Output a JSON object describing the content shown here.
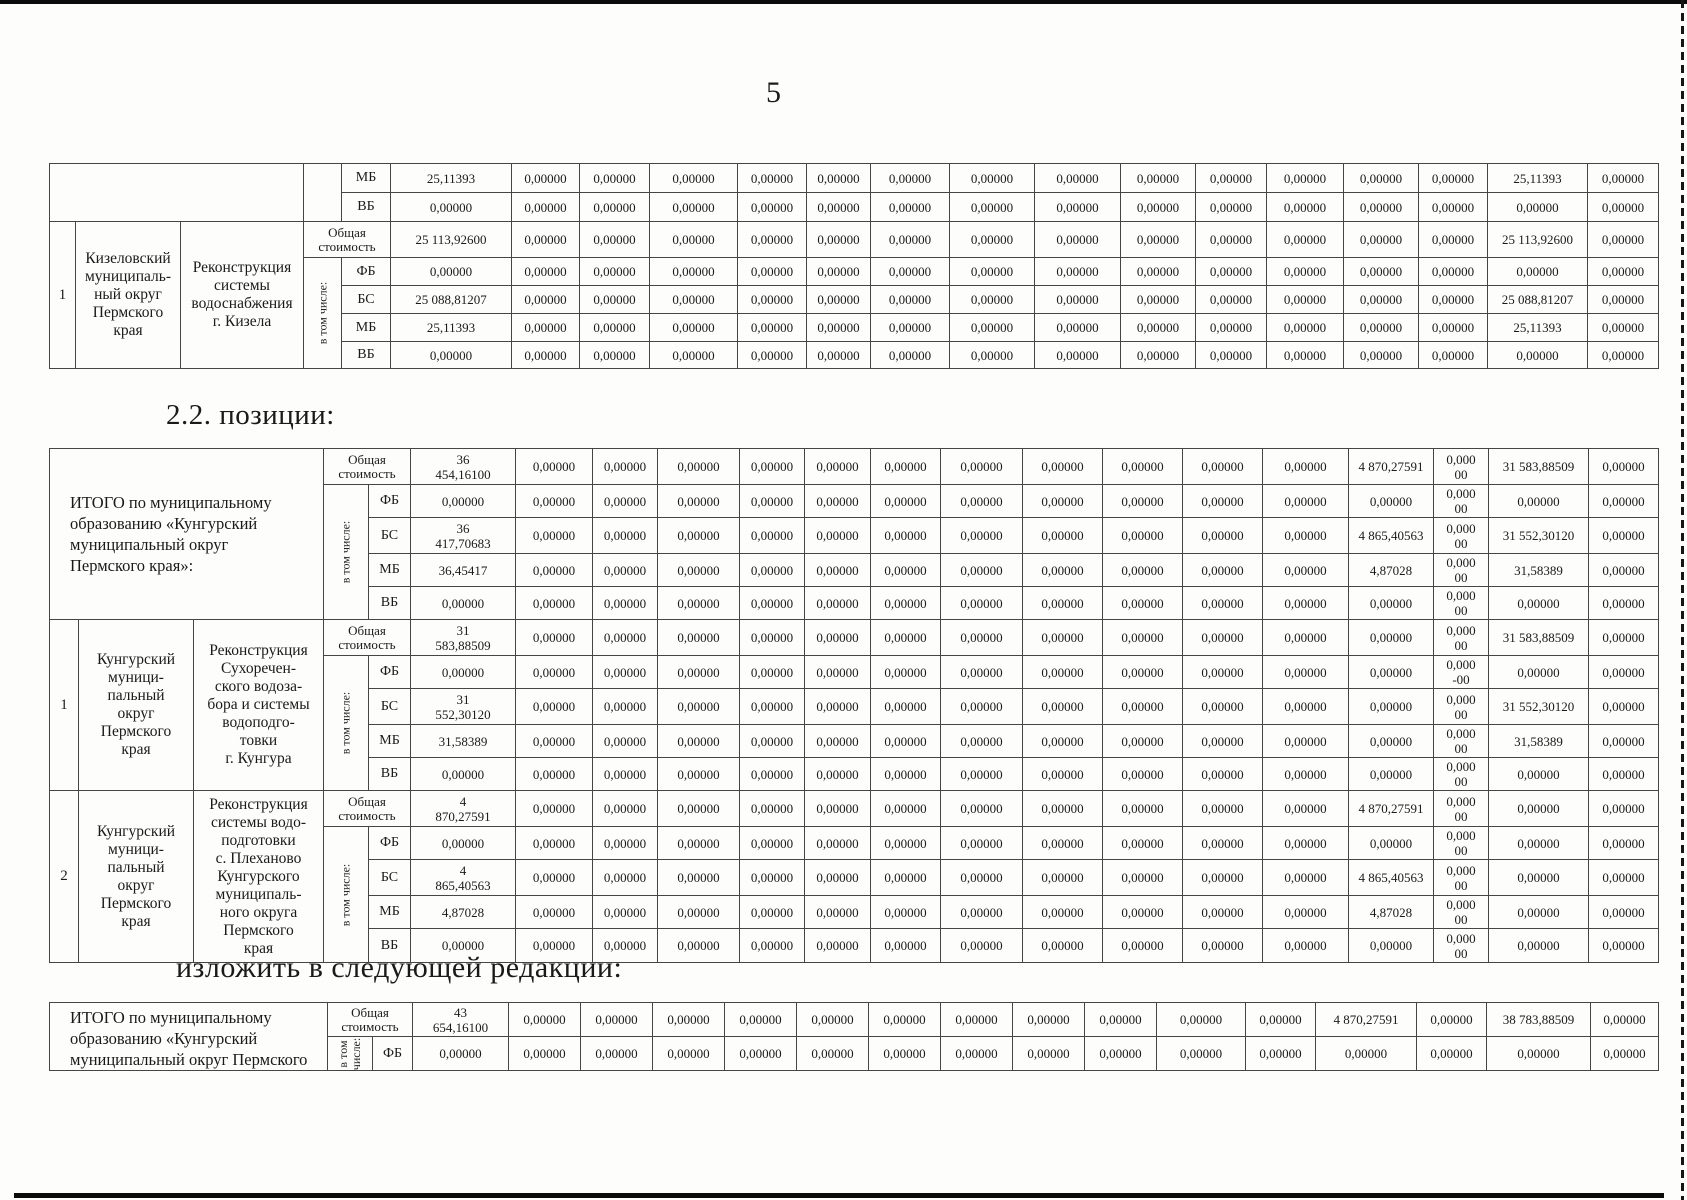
{
  "page": {
    "number": "5"
  },
  "headings": {
    "positions": "2.2. позиции:",
    "redaction": "изложить в следующей редакции:"
  },
  "labels": {
    "including": "в том числе:"
  },
  "tables": {
    "table1": {
      "col_widths": [
        26,
        105,
        123,
        38,
        49,
        121,
        68,
        70,
        88,
        69,
        64,
        79,
        85,
        86,
        75,
        71,
        77,
        75,
        69,
        100,
        71
      ],
      "row_heights": [
        29,
        29,
        36,
        28,
        28,
        28,
        27
      ],
      "groups": [
        {
          "type": "continuation",
          "rows": [
            {
              "source": "МБ",
              "values": [
                "25,11393",
                "0,00000",
                "0,00000",
                "0,00000",
                "0,00000",
                "0,00000",
                "0,00000",
                "0,00000",
                "0,00000",
                "0,00000",
                "0,00000",
                "0,00000",
                "0,00000",
                "0,00000",
                "25,11393",
                "0,00000"
              ]
            },
            {
              "source": "ВБ",
              "values": [
                "0,00000",
                "0,00000",
                "0,00000",
                "0,00000",
                "0,00000",
                "0,00000",
                "0,00000",
                "0,00000",
                "0,00000",
                "0,00000",
                "0,00000",
                "0,00000",
                "0,00000",
                "0,00000",
                "0,00000",
                "0,00000"
              ]
            }
          ]
        },
        {
          "type": "entry",
          "num": "1",
          "municipality": "Кизеловский\nмуниципаль-\nный округ\nПермского\nкрая",
          "project": "Реконструкция\nсистемы\nводоснабжения\nг. Кизела",
          "rows": [
            {
              "source": "Общая стоимость",
              "values": [
                "25 113,92600",
                "0,00000",
                "0,00000",
                "0,00000",
                "0,00000",
                "0,00000",
                "0,00000",
                "0,00000",
                "0,00000",
                "0,00000",
                "0,00000",
                "0,00000",
                "0,00000",
                "0,00000",
                "25 113,92600",
                "0,00000"
              ]
            },
            {
              "source": "ФБ",
              "values": [
                "0,00000",
                "0,00000",
                "0,00000",
                "0,00000",
                "0,00000",
                "0,00000",
                "0,00000",
                "0,00000",
                "0,00000",
                "0,00000",
                "0,00000",
                "0,00000",
                "0,00000",
                "0,00000",
                "0,00000",
                "0,00000"
              ]
            },
            {
              "source": "БС",
              "values": [
                "25 088,81207",
                "0,00000",
                "0,00000",
                "0,00000",
                "0,00000",
                "0,00000",
                "0,00000",
                "0,00000",
                "0,00000",
                "0,00000",
                "0,00000",
                "0,00000",
                "0,00000",
                "0,00000",
                "25 088,81207",
                "0,00000"
              ]
            },
            {
              "source": "МБ",
              "values": [
                "25,11393",
                "0,00000",
                "0,00000",
                "0,00000",
                "0,00000",
                "0,00000",
                "0,00000",
                "0,00000",
                "0,00000",
                "0,00000",
                "0,00000",
                "0,00000",
                "0,00000",
                "0,00000",
                "25,11393",
                "0,00000"
              ]
            },
            {
              "source": "ВБ",
              "values": [
                "0,00000",
                "0,00000",
                "0,00000",
                "0,00000",
                "0,00000",
                "0,00000",
                "0,00000",
                "0,00000",
                "0,00000",
                "0,00000",
                "0,00000",
                "0,00000",
                "0,00000",
                "0,00000",
                "0,00000",
                "0,00000"
              ]
            }
          ]
        }
      ]
    },
    "table2": {
      "col_widths": [
        29,
        115,
        130,
        45,
        42,
        105,
        77,
        65,
        82,
        65,
        66,
        70,
        82,
        80,
        80,
        80,
        86,
        85,
        55,
        100,
        70
      ],
      "row_heights": [
        36,
        31,
        36,
        31,
        31,
        36,
        31,
        36,
        31,
        31,
        36,
        31,
        36,
        31,
        34
      ],
      "groups": [
        {
          "type": "summary",
          "title": "ИТОГО по муниципальному\nобразованию «Кунгурский\nмуниципальный округ\nПермского края»:",
          "rows": [
            {
              "source": "Общая стоимость",
              "values": [
                "36\n454,16100",
                "0,00000",
                "0,00000",
                "0,00000",
                "0,00000",
                "0,00000",
                "0,00000",
                "0,00000",
                "0,00000",
                "0,00000",
                "0,00000",
                "0,00000",
                "4 870,27591",
                "0,000\n00",
                "31 583,88509",
                "0,00000"
              ]
            },
            {
              "source": "ФБ",
              "values": [
                "0,00000",
                "0,00000",
                "0,00000",
                "0,00000",
                "0,00000",
                "0,00000",
                "0,00000",
                "0,00000",
                "0,00000",
                "0,00000",
                "0,00000",
                "0,00000",
                "0,00000",
                "0,000\n00",
                "0,00000",
                "0,00000"
              ]
            },
            {
              "source": "БС",
              "values": [
                "36\n417,70683",
                "0,00000",
                "0,00000",
                "0,00000",
                "0,00000",
                "0,00000",
                "0,00000",
                "0,00000",
                "0,00000",
                "0,00000",
                "0,00000",
                "0,00000",
                "4 865,40563",
                "0,000\n00",
                "31 552,30120",
                "0,00000"
              ]
            },
            {
              "source": "МБ",
              "values": [
                "36,45417",
                "0,00000",
                "0,00000",
                "0,00000",
                "0,00000",
                "0,00000",
                "0,00000",
                "0,00000",
                "0,00000",
                "0,00000",
                "0,00000",
                "0,00000",
                "4,87028",
                "0,000\n00",
                "31,58389",
                "0,00000"
              ]
            },
            {
              "source": "ВБ",
              "values": [
                "0,00000",
                "0,00000",
                "0,00000",
                "0,00000",
                "0,00000",
                "0,00000",
                "0,00000",
                "0,00000",
                "0,00000",
                "0,00000",
                "0,00000",
                "0,00000",
                "0,00000",
                "0,000\n00",
                "0,00000",
                "0,00000"
              ]
            }
          ]
        },
        {
          "type": "entry",
          "num": "1",
          "municipality": "Кунгурский\nмуници-\nпальный\nокруг\nПермского\nкрая",
          "project": "Реконструкция\nСухоречен-\nского водоза-\nбора и системы\nводоподго-\nтовки\nг. Кунгура",
          "rows": [
            {
              "source": "Общая стоимость",
              "values": [
                "31\n583,88509",
                "0,00000",
                "0,00000",
                "0,00000",
                "0,00000",
                "0,00000",
                "0,00000",
                "0,00000",
                "0,00000",
                "0,00000",
                "0,00000",
                "0,00000",
                "0,00000",
                "0,000\n00",
                "31 583,88509",
                "0,00000"
              ]
            },
            {
              "source": "ФБ",
              "values": [
                "0,00000",
                "0,00000",
                "0,00000",
                "0,00000",
                "0,00000",
                "0,00000",
                "0,00000",
                "0,00000",
                "0,00000",
                "0,00000",
                "0,00000",
                "0,00000",
                "0,00000",
                "0,000\n-00",
                "0,00000",
                "0,00000"
              ]
            },
            {
              "source": "БС",
              "values": [
                "31\n552,30120",
                "0,00000",
                "0,00000",
                "0,00000",
                "0,00000",
                "0,00000",
                "0,00000",
                "0,00000",
                "0,00000",
                "0,00000",
                "0,00000",
                "0,00000",
                "0,00000",
                "0,000\n00",
                "31 552,30120",
                "0,00000"
              ]
            },
            {
              "source": "МБ",
              "values": [
                "31,58389",
                "0,00000",
                "0,00000",
                "0,00000",
                "0,00000",
                "0,00000",
                "0,00000",
                "0,00000",
                "0,00000",
                "0,00000",
                "0,00000",
                "0,00000",
                "0,00000",
                "0,000\n00",
                "31,58389",
                "0,00000"
              ]
            },
            {
              "source": "ВБ",
              "values": [
                "0,00000",
                "0,00000",
                "0,00000",
                "0,00000",
                "0,00000",
                "0,00000",
                "0,00000",
                "0,00000",
                "0,00000",
                "0,00000",
                "0,00000",
                "0,00000",
                "0,00000",
                "0,000\n00",
                "0,00000",
                "0,00000"
              ]
            }
          ]
        },
        {
          "type": "entry",
          "num": "2",
          "municipality": "Кунгурский\nмуници-\nпальный\nокруг\nПермского\nкрая",
          "project": "Реконструкция\nсистемы водо-\nподготовки\nс. Плеханово\nКунгурского\nмуниципаль-\nного округа\nПермского\nкрая",
          "rows": [
            {
              "source": "Общая стоимость",
              "values": [
                "4\n870,27591",
                "0,00000",
                "0,00000",
                "0,00000",
                "0,00000",
                "0,00000",
                "0,00000",
                "0,00000",
                "0,00000",
                "0,00000",
                "0,00000",
                "0,00000",
                "4 870,27591",
                "0,000\n00",
                "0,00000",
                "0,00000"
              ]
            },
            {
              "source": "ФБ",
              "values": [
                "0,00000",
                "0,00000",
                "0,00000",
                "0,00000",
                "0,00000",
                "0,00000",
                "0,00000",
                "0,00000",
                "0,00000",
                "0,00000",
                "0,00000",
                "0,00000",
                "0,00000",
                "0,000\n00",
                "0,00000",
                "0,00000"
              ]
            },
            {
              "source": "БС",
              "values": [
                "4\n865,40563",
                "0,00000",
                "0,00000",
                "0,00000",
                "0,00000",
                "0,00000",
                "0,00000",
                "0,00000",
                "0,00000",
                "0,00000",
                "0,00000",
                "0,00000",
                "4 865,40563",
                "0,000\n00",
                "0,00000",
                "0,00000"
              ]
            },
            {
              "source": "МБ",
              "values": [
                "4,87028",
                "0,00000",
                "0,00000",
                "0,00000",
                "0,00000",
                "0,00000",
                "0,00000",
                "0,00000",
                "0,00000",
                "0,00000",
                "0,00000",
                "0,00000",
                "4,87028",
                "0,000\n00",
                "0,00000",
                "0,00000"
              ]
            },
            {
              "source": "ВБ",
              "values": [
                "0,00000",
                "0,00000",
                "0,00000",
                "0,00000",
                "0,00000",
                "0,00000",
                "0,00000",
                "0,00000",
                "0,00000",
                "0,00000",
                "0,00000",
                "0,00000",
                "0,00000",
                "0,000\n00",
                "0,00000",
                "0,00000"
              ]
            }
          ]
        }
      ]
    },
    "table3": {
      "col_widths": [
        30,
        118,
        130,
        45,
        40,
        96,
        72,
        72,
        72,
        72,
        72,
        72,
        72,
        72,
        72,
        89,
        70,
        101,
        70,
        104,
        68
      ],
      "row_heights": [
        34,
        34
      ],
      "groups": [
        {
          "type": "summary",
          "cut": true,
          "title": "ИТОГО по муниципальному\nобразованию «Кунгурский\nмуниципальный округ Пермского",
          "rows": [
            {
              "source": "Общая стоимость",
              "values": [
                "43\n654,16100",
                "0,00000",
                "0,00000",
                "0,00000",
                "0,00000",
                "0,00000",
                "0,00000",
                "0,00000",
                "0,00000",
                "0,00000",
                "0,00000",
                "0,00000",
                "4 870,27591",
                "0,00000",
                "38 783,88509",
                "0,00000"
              ]
            },
            {
              "source": "ФБ",
              "values": [
                "0,00000",
                "0,00000",
                "0,00000",
                "0,00000",
                "0,00000",
                "0,00000",
                "0,00000",
                "0,00000",
                "0,00000",
                "0,00000",
                "0,00000",
                "0,00000",
                "0,00000",
                "0,00000",
                "0,00000",
                "0,00000"
              ]
            }
          ]
        }
      ]
    }
  }
}
